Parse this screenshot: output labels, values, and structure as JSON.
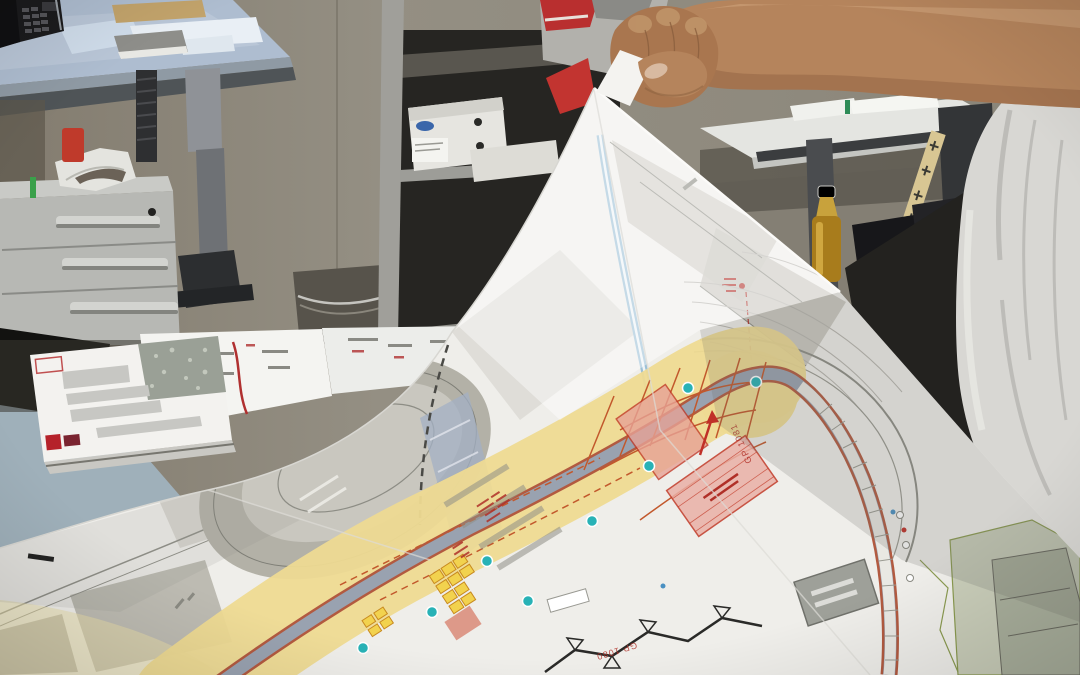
{
  "scene": {
    "description": "Photograph of a person lifting the corner of a large printed construction site development plan, spread over an office desk",
    "setting": "office interior with desks, drawer unit, shelving, phone, papers, a bottle and a folding ruler"
  },
  "plan": {
    "labels": {
      "gp_1081": "GP 1081",
      "gp_1080": "GP 1080"
    }
  },
  "colors": {
    "wall": "#8d8679",
    "floor": "#57534b",
    "desk_blue_top": "#aebdd0",
    "drawer_front": "#b7b8b4",
    "back_desk_top": "#e4e5e1",
    "shirt": "#d8d7d3",
    "skin": "#b5845c",
    "plan_paper": "#efeeea",
    "plan_yellow": "#eeda92",
    "road_fill": "#99a2b0",
    "road_edge": "#b25a40",
    "grid_orange": "#c2582c",
    "zone_pink": "#eab0a6",
    "marker_teal": "#28b2b6",
    "label_red": "#b03028",
    "channel_blue": "#9cc0d6",
    "parcel_gray": "#c0beb6",
    "booklet_red": "#b5222a",
    "bottle_olive": "#a87c1c"
  }
}
